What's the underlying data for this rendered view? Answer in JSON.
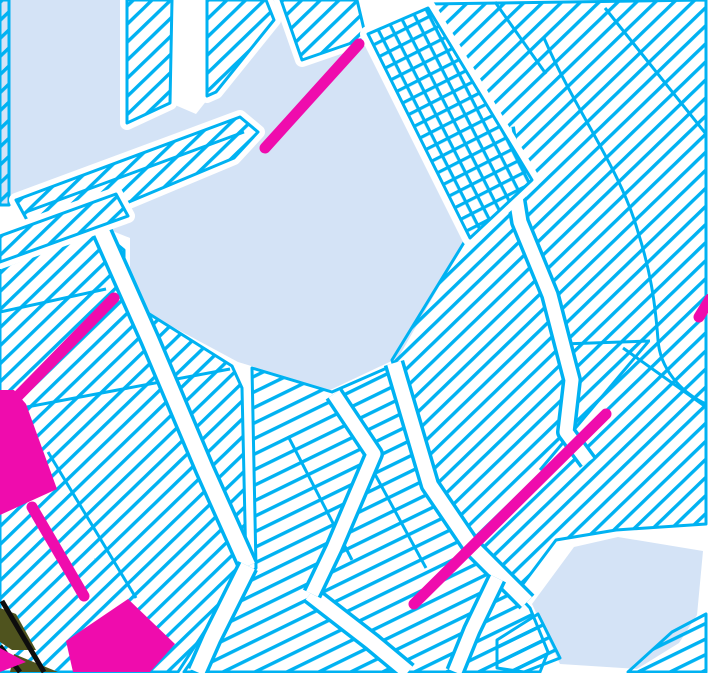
{
  "map": {
    "canvas": {
      "width": 708,
      "height": 673
    },
    "colors": {
      "background": "#ffffff",
      "water": "#d4e3f6",
      "parcel": "#00b2f2",
      "road": "#ffffff",
      "highlight": "#ef0cad",
      "olive": "#4f531e",
      "black": "#0d0d0d"
    },
    "hatches": {
      "A": {
        "spacing": 13,
        "angle": -44,
        "stroke": 3.4
      },
      "B": {
        "spacing": 14,
        "angle": -26,
        "stroke": 3.4
      },
      "G": {
        "spacing": 13,
        "angle": 63,
        "stroke": 3.2,
        "grid": true
      }
    },
    "layers": [
      {
        "name": "water-main",
        "kind": "water",
        "points": [
          [
            8,
            0
          ],
          [
            280,
            0
          ],
          [
            300,
            62
          ],
          [
            358,
            43
          ],
          [
            365,
            40
          ],
          [
            468,
            236
          ],
          [
            398,
            358
          ],
          [
            330,
            390
          ],
          [
            238,
            362
          ],
          [
            130,
            304
          ],
          [
            130,
            238
          ],
          [
            60,
            210
          ],
          [
            0,
            205
          ],
          [
            0,
            0
          ]
        ]
      },
      {
        "name": "water-pond-southeast",
        "kind": "water",
        "points": [
          [
            532,
            604
          ],
          [
            574,
            547
          ],
          [
            618,
            537
          ],
          [
            703,
            551
          ],
          [
            697,
            615
          ],
          [
            679,
            643
          ],
          [
            637,
            669
          ],
          [
            560,
            664
          ]
        ]
      },
      {
        "name": "road-trunk",
        "kind": "white",
        "points": [
          [
            174,
            0
          ],
          [
            205,
            0
          ],
          [
            215,
            90
          ],
          [
            196,
            114
          ],
          [
            168,
            102
          ]
        ]
      },
      {
        "name": "parcel-left-edge-strip",
        "kind": "parcel",
        "hatch": "A",
        "points": [
          [
            0,
            0
          ],
          [
            9,
            0
          ],
          [
            9,
            205
          ],
          [
            0,
            205
          ]
        ]
      },
      {
        "name": "parcel-field-west",
        "kind": "parcel",
        "hatch": "A",
        "points": [
          [
            0,
            268
          ],
          [
            100,
            230
          ],
          [
            124,
            250
          ],
          [
            124,
            298
          ],
          [
            232,
            366
          ],
          [
            242,
            388
          ],
          [
            246,
            568
          ],
          [
            178,
            672
          ],
          [
            0,
            672
          ]
        ]
      },
      {
        "name": "parcel-field-south",
        "kind": "parcel",
        "hatch": "B",
        "points": [
          [
            252,
            368
          ],
          [
            332,
            392
          ],
          [
            396,
            364
          ],
          [
            434,
            486
          ],
          [
            476,
            550
          ],
          [
            530,
            608
          ],
          [
            548,
            652
          ],
          [
            540,
            672
          ],
          [
            184,
            672
          ],
          [
            256,
            568
          ]
        ]
      },
      {
        "name": "parcel-field-east",
        "kind": "parcel",
        "hatch": "A",
        "points": [
          [
            428,
            4
          ],
          [
            706,
            0
          ],
          [
            706,
            524
          ],
          [
            616,
            530
          ],
          [
            556,
            540
          ],
          [
            520,
            588
          ],
          [
            468,
            538
          ],
          [
            430,
            482
          ],
          [
            392,
            360
          ],
          [
            468,
            236
          ],
          [
            368,
            36
          ]
        ]
      },
      {
        "name": "parcel-corner-southeast",
        "kind": "parcel",
        "hatch": "B",
        "points": [
          [
            672,
            632
          ],
          [
            706,
            614
          ],
          [
            706,
            672
          ],
          [
            628,
            672
          ]
        ]
      },
      {
        "name": "parcel-pond-south",
        "kind": "parcel",
        "hatch": "B",
        "points": [
          [
            497,
            640
          ],
          [
            538,
            614
          ],
          [
            560,
            658
          ],
          [
            524,
            672
          ],
          [
            497,
            668
          ]
        ]
      },
      {
        "name": "parcel-boundary",
        "kind": "inner",
        "points": [
          [
            0,
            412
          ],
          [
            230,
            369
          ]
        ]
      },
      {
        "name": "parcel-boundary",
        "kind": "inner",
        "points": [
          [
            0,
            312
          ],
          [
            106,
            289
          ]
        ]
      },
      {
        "name": "parcel-boundary",
        "kind": "inner",
        "points": [
          [
            48,
            452
          ],
          [
            136,
            598
          ]
        ]
      },
      {
        "name": "parcel-boundary",
        "kind": "inner",
        "points": [
          [
            288,
            436
          ],
          [
            352,
            560
          ]
        ]
      },
      {
        "name": "parcel-boundary",
        "kind": "inner",
        "points": [
          [
            352,
            432
          ],
          [
            426,
            568
          ]
        ]
      },
      {
        "name": "parcel-boundary",
        "kind": "inner",
        "points": [
          [
            605,
            8
          ],
          [
            706,
            134
          ]
        ]
      },
      {
        "name": "parcel-boundary",
        "kind": "inner",
        "points": [
          [
            495,
            2
          ],
          [
            546,
            74
          ]
        ]
      },
      {
        "name": "parcel-boundary",
        "kind": "inner",
        "points": [
          [
            562,
            344
          ],
          [
            650,
            341
          ]
        ]
      },
      {
        "name": "parcel-boundary",
        "kind": "inner",
        "points": [
          [
            623,
            348
          ],
          [
            706,
            407
          ]
        ]
      },
      {
        "name": "parcel-boundary",
        "kind": "inner",
        "points": [
          [
            540,
            470
          ],
          [
            648,
            342
          ]
        ]
      },
      {
        "name": "parcel-boundary-curve",
        "kind": "curve",
        "d": "M544,38 C576,112 620,168 638,232 C650,270 655,300 658,340 C660,368 680,392 706,404"
      },
      {
        "name": "road",
        "kind": "road",
        "width": 15,
        "points": [
          [
            102,
            232
          ],
          [
            150,
            340
          ],
          [
            205,
            470
          ],
          [
            248,
            566
          ]
        ]
      },
      {
        "name": "road",
        "kind": "road",
        "width": 15,
        "points": [
          [
            248,
            566
          ],
          [
            212,
            638
          ],
          [
            197,
            672
          ]
        ]
      },
      {
        "name": "road",
        "kind": "road",
        "width": 14,
        "points": [
          [
            310,
            594
          ],
          [
            372,
            642
          ],
          [
            408,
            672
          ]
        ]
      },
      {
        "name": "road",
        "kind": "road",
        "width": 13,
        "points": [
          [
            334,
            394
          ],
          [
            374,
            454
          ],
          [
            334,
            548
          ],
          [
            312,
            594
          ]
        ]
      },
      {
        "name": "road",
        "kind": "road",
        "width": 14,
        "points": [
          [
            394,
            363
          ],
          [
            430,
            485
          ],
          [
            472,
            547
          ],
          [
            527,
            602
          ]
        ]
      },
      {
        "name": "road",
        "kind": "road",
        "width": 13,
        "points": [
          [
            497,
            578
          ],
          [
            472,
            630
          ],
          [
            455,
            672
          ]
        ]
      },
      {
        "name": "road",
        "kind": "road",
        "width": 13,
        "points": [
          [
            505,
            128
          ],
          [
            520,
            222
          ],
          [
            550,
            295
          ],
          [
            572,
            380
          ],
          [
            566,
            432
          ],
          [
            588,
            462
          ]
        ]
      },
      {
        "name": "parcel-bar-north-a",
        "kind": "parcel",
        "hatch": "A",
        "halo": 7,
        "points": [
          [
            127,
            0
          ],
          [
            172,
            0
          ],
          [
            170,
            103
          ],
          [
            127,
            123
          ]
        ]
      },
      {
        "name": "parcel-bar-north-b",
        "kind": "parcel",
        "hatch": "A",
        "halo": 7,
        "points": [
          [
            207,
            0
          ],
          [
            266,
            0
          ],
          [
            274,
            20
          ],
          [
            216,
            92
          ],
          [
            207,
            96
          ]
        ]
      },
      {
        "name": "parcel-bar-north-c",
        "kind": "parcel",
        "hatch": "A",
        "halo": 7,
        "points": [
          [
            281,
            0
          ],
          [
            357,
            0
          ],
          [
            366,
            38
          ],
          [
            302,
            60
          ]
        ]
      },
      {
        "name": "parcel-bar-long",
        "kind": "parcel",
        "hatch": "A",
        "halo": 7,
        "inner": [
          [
            26,
            212
          ],
          [
            244,
            132
          ]
        ],
        "points": [
          [
            16,
            200
          ],
          [
            240,
            117
          ],
          [
            258,
            132
          ],
          [
            234,
            158
          ],
          [
            38,
            240
          ]
        ]
      },
      {
        "name": "parcel-bar-short",
        "kind": "parcel",
        "hatch": "A",
        "halo": 7,
        "points": [
          [
            0,
            236
          ],
          [
            116,
            194
          ],
          [
            128,
            216
          ],
          [
            0,
            262
          ]
        ]
      },
      {
        "name": "parcel-grid",
        "kind": "parcel",
        "hatch": "G",
        "halo": 8,
        "points": [
          [
            368,
            34
          ],
          [
            428,
            8
          ],
          [
            532,
            180
          ],
          [
            470,
            238
          ]
        ]
      },
      {
        "name": "terrain-olive",
        "kind": "cpoly",
        "color": "olive",
        "points": [
          [
            0,
            608
          ],
          [
            16,
            614
          ],
          [
            36,
            650
          ],
          [
            12,
            650
          ],
          [
            0,
            642
          ]
        ]
      },
      {
        "name": "terrain-olive",
        "kind": "cpoly",
        "color": "olive",
        "points": [
          [
            14,
            654
          ],
          [
            58,
            672
          ],
          [
            10,
            672
          ]
        ]
      },
      {
        "name": "terrain-black-line",
        "kind": "cline",
        "color": "black",
        "width": 5,
        "x1": 2,
        "y1": 601,
        "x2": 44,
        "y2": 672
      },
      {
        "name": "terrain-black-line",
        "kind": "cline",
        "color": "black",
        "width": 5,
        "x1": 0,
        "y1": 646,
        "x2": 20,
        "y2": 672
      },
      {
        "name": "highlight-line",
        "kind": "hline",
        "width": 11,
        "x1": 265,
        "y1": 148,
        "x2": 359,
        "y2": 44
      },
      {
        "name": "highlight-line",
        "kind": "hline",
        "width": 11,
        "x1": 114,
        "y1": 298,
        "x2": 17,
        "y2": 397
      },
      {
        "name": "highlight-wedge",
        "kind": "hpoly",
        "points": [
          [
            14,
            390
          ],
          [
            26,
            404
          ],
          [
            57,
            489
          ],
          [
            0,
            515
          ],
          [
            0,
            390
          ]
        ]
      },
      {
        "name": "highlight-line",
        "kind": "hline",
        "width": 11,
        "x1": 32,
        "y1": 507,
        "x2": 84,
        "y2": 596
      },
      {
        "name": "highlight-block",
        "kind": "hpoly",
        "points": [
          [
            128,
            599
          ],
          [
            175,
            644
          ],
          [
            150,
            672
          ],
          [
            73,
            672
          ],
          [
            66,
            641
          ]
        ]
      },
      {
        "name": "highlight-line",
        "kind": "hline",
        "width": 11,
        "x1": 606,
        "y1": 414,
        "x2": 414,
        "y2": 604
      },
      {
        "name": "highlight-line",
        "kind": "hline",
        "width": 11,
        "x1": 710,
        "y1": 299,
        "x2": 699,
        "y2": 317
      },
      {
        "name": "highlight-triangle",
        "kind": "hpoly",
        "points": [
          [
            0,
            648
          ],
          [
            26,
            662
          ],
          [
            0,
            672
          ]
        ]
      }
    ]
  }
}
